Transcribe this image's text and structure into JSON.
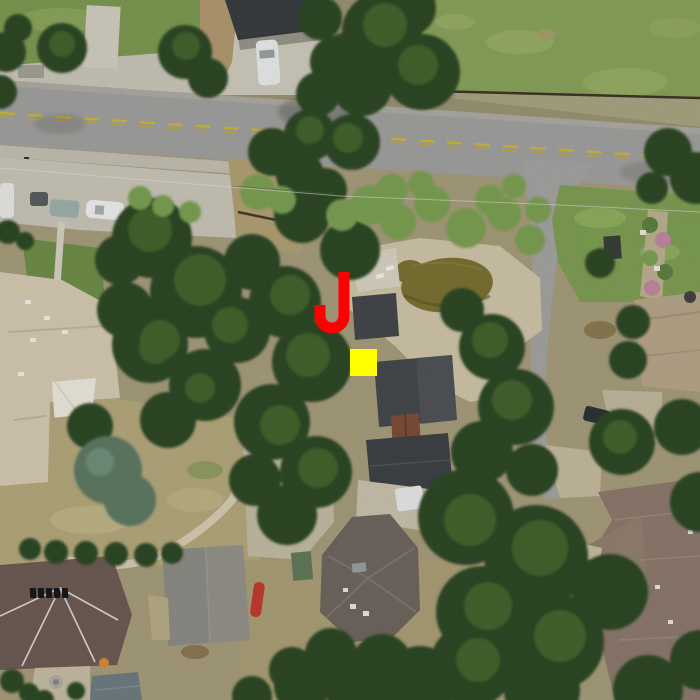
{
  "image": {
    "kind": "aerial-photo",
    "width_px": 700,
    "height_px": 700
  },
  "markers": {
    "j_marker": {
      "label": "J",
      "color": "#ff0000",
      "x": 314,
      "y": 270,
      "width": 36,
      "height": 64,
      "stroke_width": 11
    },
    "target_square": {
      "color": "#ffff00",
      "x": 350,
      "y": 349,
      "size": 27
    }
  },
  "scene": {
    "features": [
      "main-road-east-west",
      "dashed-yellow-center-line",
      "side-lane-north-south",
      "grass-field",
      "backyard-pond",
      "patio-deck",
      "tree-canopy",
      "beige-roof-house",
      "dark-roof-cottages",
      "rust-shed-roof",
      "hip-roof-house",
      "mauve-roof-house",
      "gray-roof-house",
      "tan-roof-house",
      "brown-roof-house",
      "shade-sail",
      "garden-beds",
      "parked-cars",
      "white-van",
      "red-kayak",
      "fence-line",
      "power-lines",
      "footpath",
      "fountain"
    ],
    "palette": {
      "road": "#a1a19f",
      "lane": "#a4a4a2",
      "yellow_line": "#cdb73a",
      "field_grass": "#8aa35c",
      "lawn": "#7f9e55",
      "dry_grass": "#b4a87c",
      "concrete": "#ccc8bb",
      "dirt": "#b29a72",
      "tree_dark": "#2e4827",
      "tree_mid": "#47682f",
      "tree_light": "#7ca052",
      "tree_bluegreen": "#5e7a64",
      "pond_water": "#7b7233",
      "beige_roof": "#d6cab2",
      "dark_roof": "#42454a",
      "mauve_roof": "#6e5b55",
      "hip_roof": "#6f675f",
      "gray_roof": "#8e8c86",
      "tan_roof": "#b7a68a",
      "brown_roof": "#8d7a6d",
      "rust_roof": "#7d4e38",
      "marker_red": "#ff0000",
      "marker_yellow": "#ffff00"
    }
  }
}
